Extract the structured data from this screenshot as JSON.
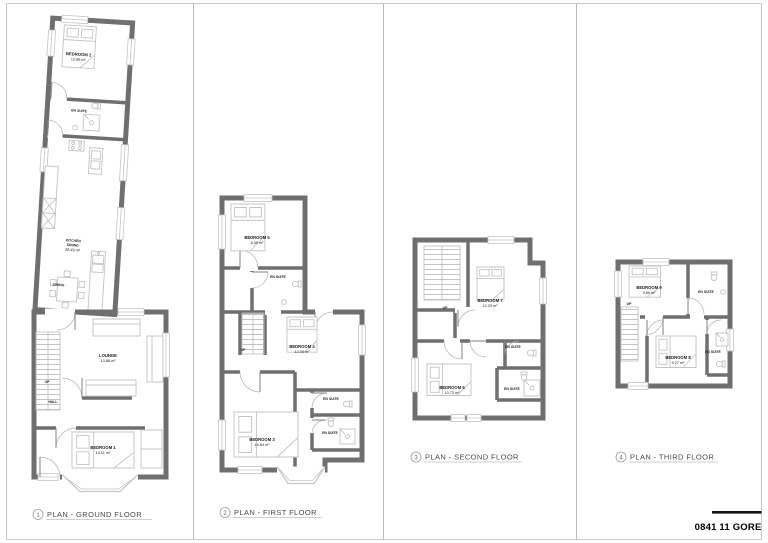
{
  "sheet": {
    "project_code": "0841 11 GORE"
  },
  "labels": {
    "up": "UP"
  },
  "plans": [
    {
      "number": "1",
      "title": "PLAN - GROUND FLOOR",
      "rooms": {
        "bedroom2": {
          "name": "BEDROOM 2",
          "area": "12.65 m²"
        },
        "ensuite": {
          "name": "EN SUITE"
        },
        "kitchen": {
          "line1": "KITCHEN",
          "line2": "DINING",
          "area": "26.49 m²"
        },
        "dining": {
          "name": "DINING"
        },
        "lounge": {
          "name": "LOUNGE",
          "area": "13.88 m²"
        },
        "hall": {
          "name": "HALL"
        },
        "bedroom1": {
          "name": "BEDROOM 1",
          "area": "13.11 m²"
        }
      }
    },
    {
      "number": "2",
      "title": "PLAN - FIRST FLOOR",
      "rooms": {
        "bedroom5": {
          "name": "BEDROOM 5",
          "area": "8.35 m²"
        },
        "ensuite_top": {
          "name": "EN SUITE"
        },
        "bedroom4": {
          "name": "BEDROOM 4",
          "area": "12.05 m²"
        },
        "ensuite_mid": {
          "name": "EN SUITE"
        },
        "ensuite_low": {
          "name": "EN SUITE"
        },
        "bedroom3": {
          "name": "BEDROOM 3",
          "area": "15.84 m²"
        }
      }
    },
    {
      "number": "3",
      "title": "PLAN - SECOND FLOOR",
      "rooms": {
        "bedroom7": {
          "name": "BEDROOM 7",
          "area": "12.20 m²"
        },
        "ensuite_top": {
          "name": "EN SUITE"
        },
        "bedroom6": {
          "name": "BEDROOM 6",
          "area": "13.73 m²"
        },
        "ensuite_low": {
          "name": "EN SUITE"
        }
      }
    },
    {
      "number": "4",
      "title": "PLAN - THIRD FLOOR",
      "rooms": {
        "bedroom9": {
          "name": "BEDROOM 9",
          "area": "9.86 m²"
        },
        "ensuite_top": {
          "name": "EN SUITE"
        },
        "bedroom8": {
          "name": "BEDROOM 8",
          "area": "9.27 m²"
        },
        "ensuite_right": {
          "name": "EN SUITE"
        }
      }
    }
  ]
}
